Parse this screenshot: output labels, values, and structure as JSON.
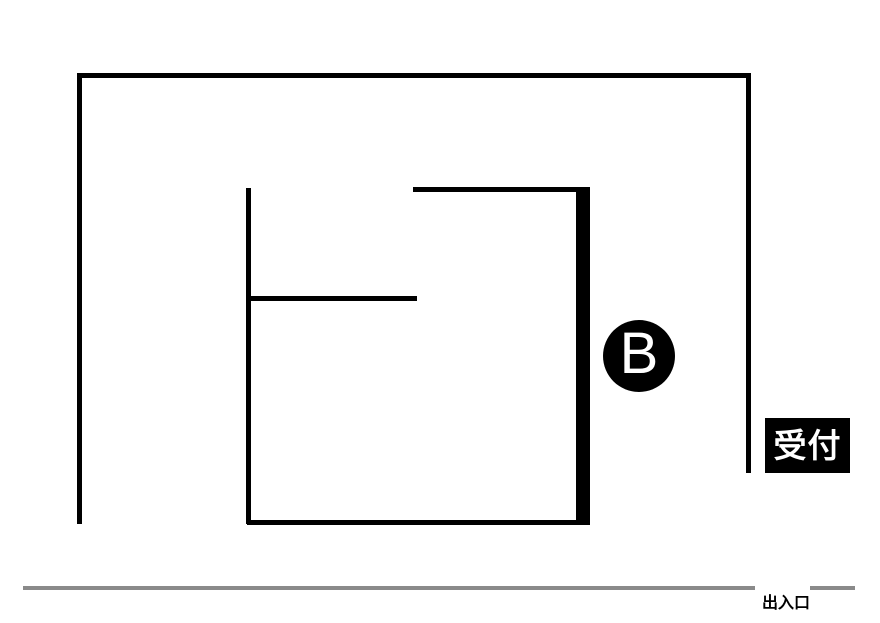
{
  "diagram": {
    "type": "floor-plan",
    "background_color": "#ffffff",
    "wall_color": "#000000",
    "entrance_line_color": "#8a8a8a",
    "walls": [
      {
        "name": "outer-wall-top",
        "x": 77,
        "y": 73,
        "w": 674,
        "h": 5
      },
      {
        "name": "outer-wall-left",
        "x": 77,
        "y": 73,
        "w": 5,
        "h": 451
      },
      {
        "name": "outer-wall-right",
        "x": 746,
        "y": 73,
        "w": 5,
        "h": 400
      },
      {
        "name": "inner-wall-vertical-left",
        "x": 246,
        "y": 188,
        "w": 5,
        "h": 336
      },
      {
        "name": "inner-wall-horizontal-middle",
        "x": 246,
        "y": 296,
        "w": 171,
        "h": 5
      },
      {
        "name": "inner-wall-horizontal-top",
        "x": 413,
        "y": 187,
        "w": 177,
        "h": 5
      },
      {
        "name": "inner-wall-vertical-right-thick",
        "x": 576,
        "y": 187,
        "w": 14,
        "h": 338
      },
      {
        "name": "inner-wall-horizontal-bottom",
        "x": 247,
        "y": 520,
        "w": 343,
        "h": 5
      }
    ],
    "entrance_lines": [
      {
        "name": "entrance-line-long",
        "x": 23,
        "y": 586,
        "w": 732,
        "h": 4
      },
      {
        "name": "entrance-line-short",
        "x": 810,
        "y": 586,
        "w": 45,
        "h": 4
      }
    ],
    "marker": {
      "label": "B",
      "cx": 639,
      "cy": 356,
      "r": 36,
      "bg": "#000000",
      "fg": "#ffffff"
    },
    "reception": {
      "label": "受付",
      "x": 765,
      "y": 418,
      "w": 85,
      "h": 55,
      "bg": "#000000",
      "fg": "#ffffff"
    },
    "entrance": {
      "label": "出入口",
      "x": 762,
      "y": 596
    }
  }
}
